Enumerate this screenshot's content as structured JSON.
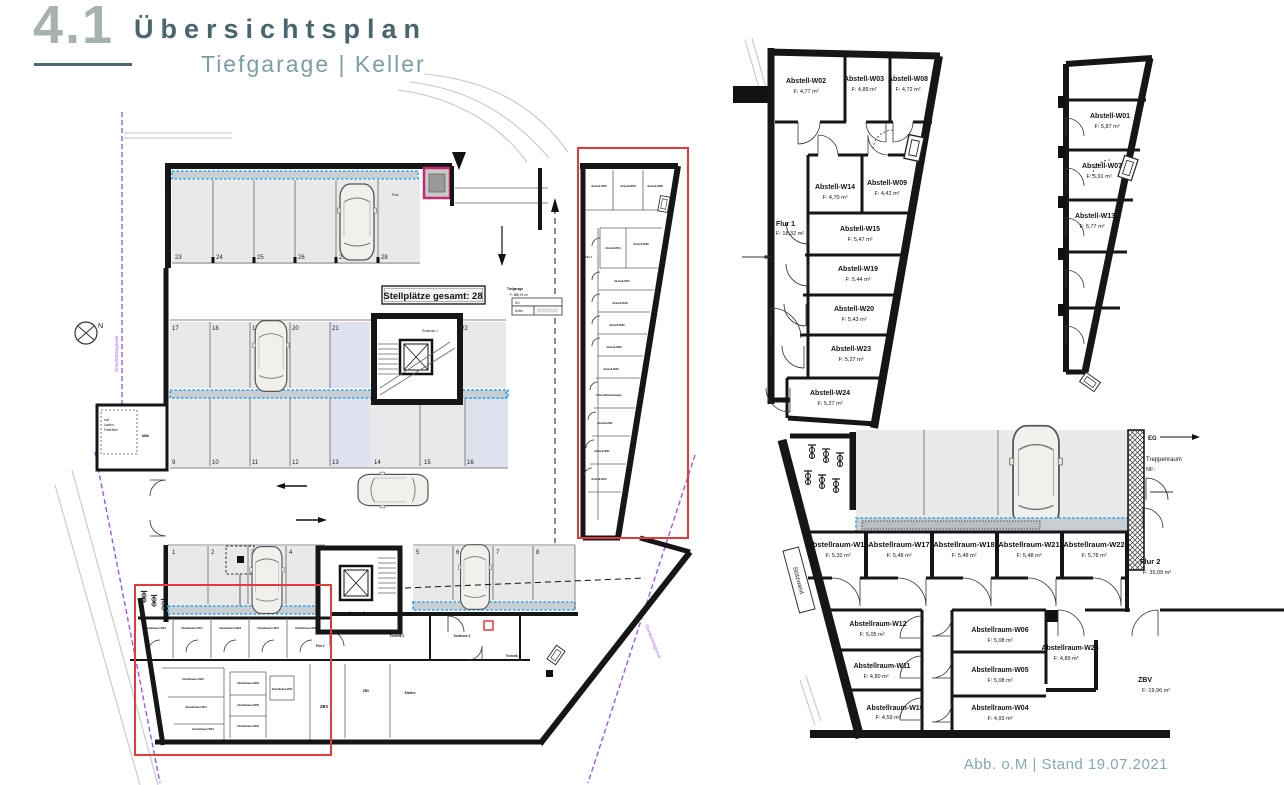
{
  "header": {
    "number": "4.1",
    "title": "Übersichtsplan",
    "subtitle": "Tiefgarage | Keller"
  },
  "footer": {
    "credit": "Abb. o.M | Stand 19.07.2021"
  },
  "main_plan": {
    "stellplaetze_label": "Stellplätze gesamt: 28",
    "area_table": {
      "title": "Tiefgarage",
      "area": "F: 886,91 m²",
      "row1": "KG",
      "row2": "Keller"
    },
    "north_label": "N",
    "boundary_label": "Grundstücksgrenze",
    "stalls_top": [
      "23",
      "24",
      "25",
      "26",
      "27",
      "28"
    ],
    "stalls_mid_top": [
      "17",
      "18",
      "19",
      "20",
      "21",
      "22"
    ],
    "stalls_mid_bottom": [
      "9",
      "10",
      "11",
      "12",
      "13",
      "14",
      "15",
      "16"
    ],
    "stalls_bottom": [
      "1",
      "2",
      "3",
      "4",
      "5",
      "6",
      "7",
      "8"
    ],
    "schleuse1": "Schleuse 1",
    "schleuse2": "Schleuse 2",
    "schleuse3": "Schleuse 3",
    "technik2": "Technik 2",
    "technik3": "Technik 3",
    "elektro": "Elektro",
    "zbv_small": "ZBV",
    "zbv_big": "ZBV",
    "muell": "Müll",
    "lasten_line1": "evtl.",
    "lasten_line2": "Lasten-",
    "lasten_line3": "Fahrräder",
    "post": "Post",
    "flur1_mini": "Flur 1",
    "flur2_mini": "Flur 2",
    "fahrrad_mini": "Fahrrad/Kinderwagen",
    "mini_strip": [
      "Abstell-W02",
      "Abstell-W03",
      "Abstell-W08",
      "Abstell-W14",
      "Abstell-W09",
      "Abstell-W15",
      "Abstell-W19",
      "Abstell-W20",
      "Abstell-W23",
      "Abstell-W24",
      "Abstell-W01",
      "Abstell-W07",
      "Abstell-W13"
    ],
    "mini_row": [
      "Abstellraum-W16",
      "Abstellraum-W17",
      "Abstellraum-W18",
      "Abstellraum-W21",
      "Abstellraum-W22"
    ],
    "mini_left": [
      "Abstellraum-W12",
      "Abstellraum-W11",
      "Abstellraum-W10"
    ],
    "mini_mid": [
      "Abstellraum-W06",
      "Abstellraum-W05",
      "Abstellraum-W04"
    ],
    "mini_w25": "Abstellraum-W25"
  },
  "plan_a": {
    "rooms": [
      {
        "name": "Abstell-W02",
        "area": "F: 4,77 m²"
      },
      {
        "name": "Abstell-W03",
        "area": "F: 4,89 m²"
      },
      {
        "name": "Abstell-W08",
        "area": "F: 4,72 m²"
      },
      {
        "name": "Abstell-W14",
        "area": "F: 4,70 m²"
      },
      {
        "name": "Abstell-W09",
        "area": "F: 4,42 m²"
      },
      {
        "name": "Abstell-W15",
        "area": "F: 5,47 m²"
      },
      {
        "name": "Abstell-W19",
        "area": "F: 5,44 m²"
      },
      {
        "name": "Abstell-W20",
        "area": "F: 5,43 m²"
      },
      {
        "name": "Abstell-W23",
        "area": "F: 5,27 m²"
      },
      {
        "name": "Abstell-W24",
        "area": "F: 5,27 m²"
      }
    ],
    "flur": {
      "name": "Flur 1",
      "area": "F: 18,32 m²"
    }
  },
  "plan_b": {
    "rooms": [
      {
        "name": "Abstell-W01",
        "area": "F: 5,87 m²"
      },
      {
        "name": "Abstell-W07",
        "area": "F: 5,91 m²"
      },
      {
        "name": "Abstell-W13",
        "area": "F: 5,77 m²"
      }
    ]
  },
  "plan_c": {
    "row": [
      {
        "name": "Abstellraum-W16",
        "area": "F: 5,32 m²"
      },
      {
        "name": "Abstellraum-W17",
        "area": "F: 5,48 m²"
      },
      {
        "name": "Abstellraum-W18",
        "area": "F: 5,48 m²"
      },
      {
        "name": "Abstellraum-W21",
        "area": "F: 5,48 m²"
      },
      {
        "name": "Abstellraum-W22",
        "area": "F: 5,78 m²"
      }
    ],
    "left": [
      {
        "name": "Abstellraum-W12",
        "area": "F: 5,05 m²"
      },
      {
        "name": "Abstellraum-W11",
        "area": "F: 4,80 m²"
      },
      {
        "name": "Abstellraum-W10",
        "area": "F: 4,59 m²"
      }
    ],
    "mid": [
      {
        "name": "Abstellraum-W06",
        "area": "F: 5,08 m²"
      },
      {
        "name": "Abstellraum-W05",
        "area": "F: 5,08 m²"
      },
      {
        "name": "Abstellraum-W04",
        "area": "F: 4,93 m²"
      }
    ],
    "w25": {
      "name": "Abstellraum-W25",
      "area": "F: 4,89 m²"
    },
    "zbv": {
      "name": "ZBV",
      "area": "F: 19,96 m²"
    },
    "flur2": {
      "name": "Flur 2",
      "area": "F: 35,09 m²"
    },
    "stuetzwand": "Stützwand",
    "eg": "EG",
    "treppenraum": "Treppenraum",
    "treppenraum_area": "NF:"
  }
}
